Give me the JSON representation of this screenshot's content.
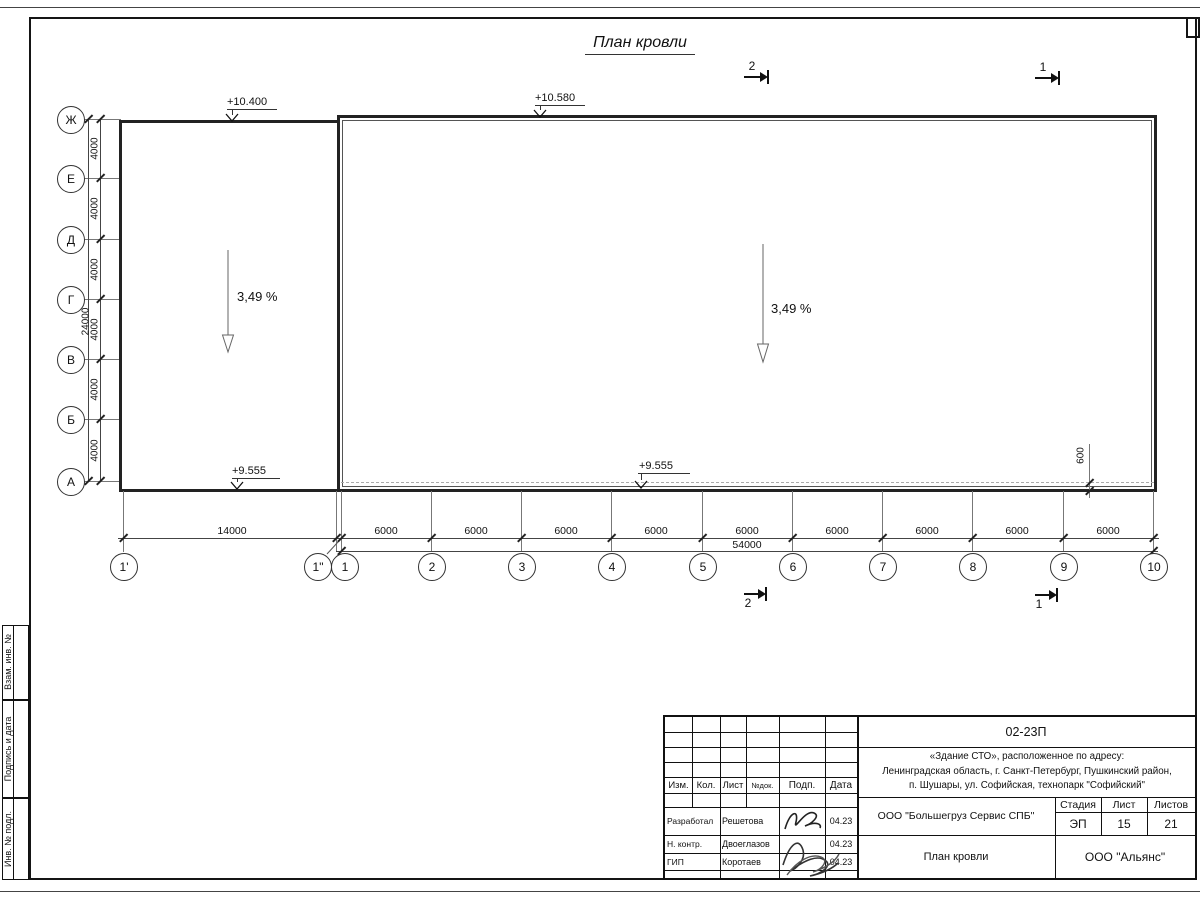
{
  "sheet": {
    "title": "План кровли"
  },
  "grid": {
    "rows": [
      {
        "label": "Ж"
      },
      {
        "label": "Е"
      },
      {
        "label": "Д"
      },
      {
        "label": "Г"
      },
      {
        "label": "В"
      },
      {
        "label": "Б"
      },
      {
        "label": "А"
      }
    ],
    "row_dims": [
      "4000",
      "4000",
      "4000",
      "4000",
      "4000",
      "4000"
    ],
    "row_total": "24000",
    "cols": [
      {
        "label": "1'"
      },
      {
        "label": "1\""
      },
      {
        "label": "1"
      },
      {
        "label": "2"
      },
      {
        "label": "3"
      },
      {
        "label": "4"
      },
      {
        "label": "5"
      },
      {
        "label": "6"
      },
      {
        "label": "7"
      },
      {
        "label": "8"
      },
      {
        "label": "9"
      },
      {
        "label": "10"
      }
    ],
    "col_dims": [
      "14000",
      "6000",
      "6000",
      "6000",
      "6000",
      "6000",
      "6000",
      "6000",
      "6000",
      "6000"
    ],
    "col_total": "54000"
  },
  "elevations": [
    "+10.400",
    "+10.580",
    "+9.555",
    "+9.555"
  ],
  "slopes": [
    "3,49 %",
    "3,49 %"
  ],
  "sections": {
    "top": [
      "2",
      "1"
    ],
    "bottom": [
      "2",
      "1"
    ]
  },
  "offset_dim": "600",
  "frame_strip": [
    "Взам. инв. №",
    "Подпись и дата",
    "Инв. № подл."
  ],
  "stamp": {
    "doc_number": "02-23П",
    "address_line1": "«Здание СТО», расположенное по адресу:",
    "address_line2": "Ленинградская область, г. Санкт-Петербург, Пушкинский район,",
    "address_line3": "п. Шушары, ул. Софийская, технопарк \"Софийский\"",
    "header_cols": {
      "izm": "Изм.",
      "kol": "Кол.",
      "list": "Лист",
      "doc": "№док.",
      "podp": "Подп.",
      "data": "Дата"
    },
    "people": [
      {
        "role": "Разработал",
        "name": "Решетова",
        "date": "04.23"
      },
      {
        "role": "Н. контр.",
        "name": "Двоеглазов",
        "date": "04.23"
      },
      {
        "role": "ГИП",
        "name": "Коротаев",
        "date": "04.23"
      }
    ],
    "org": "ООО \"Большегруз Сервис СПБ\"",
    "stage_label": "Стадия",
    "sheet_label": "Лист",
    "sheets_label": "Листов",
    "stage": "ЭП",
    "sheet_no": "15",
    "sheets_total": "21",
    "drawing_title": "План кровли",
    "company": "ООО \"Альянс\""
  }
}
